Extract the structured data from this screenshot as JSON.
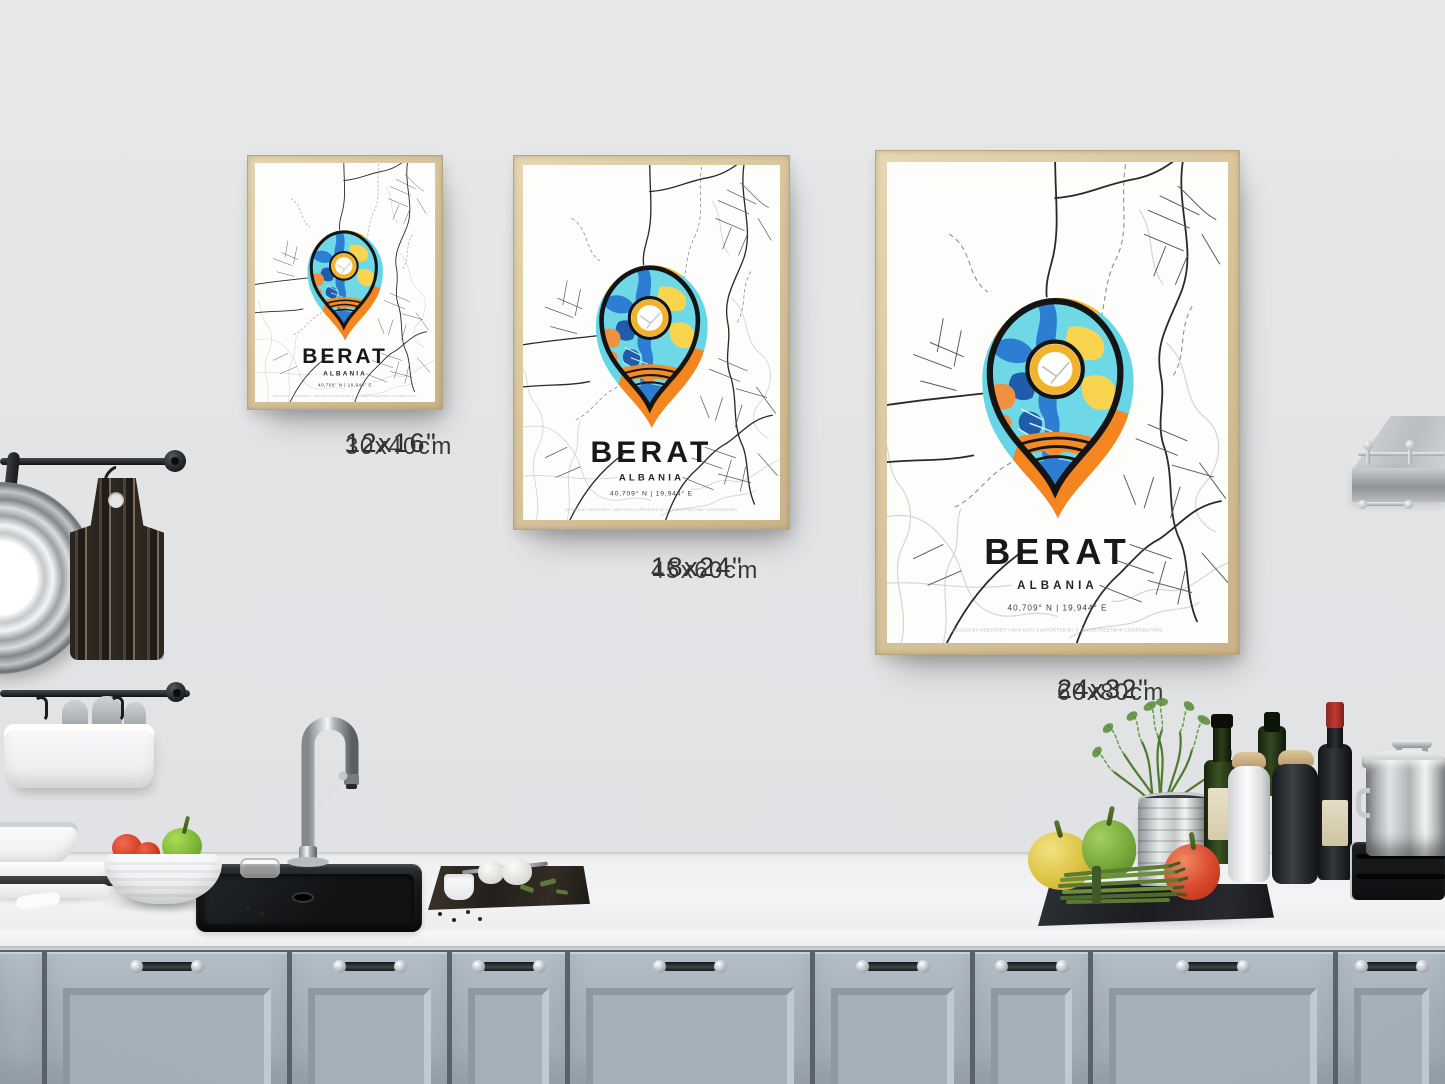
{
  "posters": [
    {
      "id": "small",
      "city": "BERAT",
      "country": "ALBANIA",
      "coordinates": "40,709° N | 19,944° E",
      "credit": "DESIGN BY HEBSTREIT | MAP DATA SUPPORTED BY © OPENSTREETMAP CONTRIBUTORS",
      "size_in": "12x16\"",
      "size_cm": "30x40cm"
    },
    {
      "id": "medium",
      "city": "BERAT",
      "country": "ALBANIA",
      "coordinates": "40,709° N | 19,944° E",
      "credit": "DESIGN BY HEBSTREIT | MAP DATA SUPPORTED BY © OPENSTREETMAP CONTRIBUTORS",
      "size_in": "18x24\"",
      "size_cm": "45x60cm"
    },
    {
      "id": "large",
      "city": "BERAT",
      "country": "ALBANIA",
      "coordinates": "40,709° N | 19,944° E",
      "credit": "DESIGN BY HEBSTREIT | MAP DATA SUPPORTED BY © OPENSTREETMAP CONTRIBUTORS",
      "size_in": "24x32\"",
      "size_cm": "60x80cm"
    }
  ],
  "colors": {
    "wall": "#e3e4e6",
    "frame_wood": "#d9c69d",
    "pin_outline": "#141414",
    "pin_turquoise": "#6fd8e6",
    "pin_blue": "#2d7dd2",
    "pin_dark_blue": "#1f5cab",
    "pin_yellow": "#f8d44f",
    "pin_orange": "#f0913f",
    "halo_yellow": "#f8b62c",
    "halo_cyan": "#66d6e6",
    "halo_orange": "#f5861f",
    "cabinet": "#a8b3bd",
    "counter": "#f1f3f4",
    "sink": "#101214"
  }
}
